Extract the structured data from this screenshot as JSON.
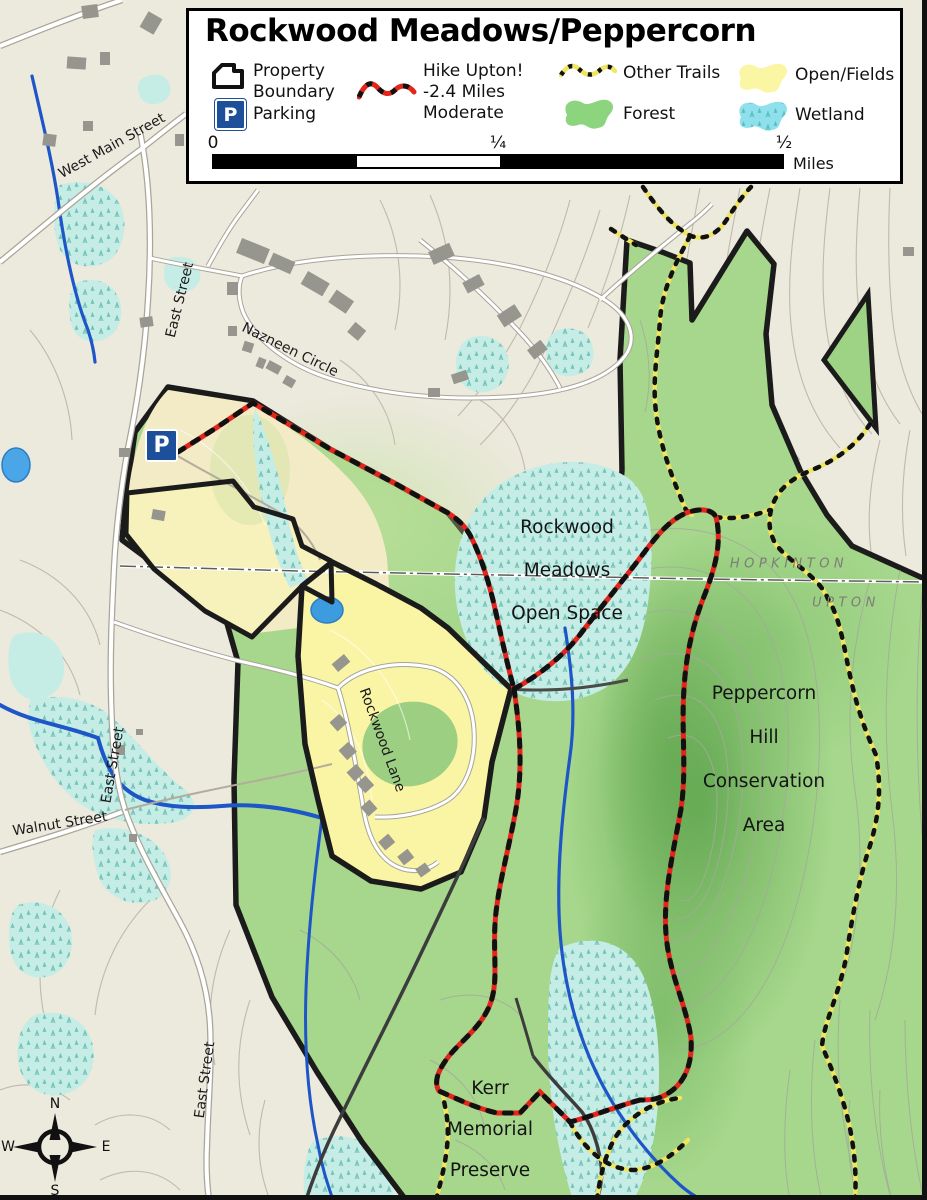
{
  "title": "Rockwood Meadows/Peppercorn",
  "legend": {
    "property_boundary": "Property\nBoundary",
    "parking": "Parking",
    "parking_symbol": "P",
    "hike": "Hike Upton!\n-2.4 Miles\nModerate",
    "other_trails": "Other Trails",
    "forest": "Forest",
    "open_fields": "Open/Fields",
    "wetland": "Wetland"
  },
  "scale_bar": {
    "tick0": "0",
    "tick1": "¼",
    "tick2": "½",
    "unit": "Miles"
  },
  "map_labels": {
    "rockwood": "Rockwood\nMeadows\nOpen Space",
    "peppercorn": "Peppercorn\nHill\nConservation\nArea",
    "kerr": "Kerr\nMemorial\nPreserve",
    "hopkinton": "HOPKINTON",
    "upton": "UPTON",
    "west_main": "West Main Street",
    "east_street": "East  Street",
    "walnut": "Walnut Street",
    "nazneen": "Nazneen Circle",
    "rockwood_lane": "Rockwood Lane",
    "parking_marker": "P"
  },
  "compass": {
    "n": "N",
    "e": "E",
    "s": "S",
    "w": "W"
  },
  "colors": {
    "forest_green": "#9AD283",
    "open_fields_yellow": "#FBF6A3",
    "wetland_cyan": "#8FE0ED",
    "water_blue": "#1E56C8",
    "hike_trail_red": "#E4251C",
    "other_trail_yellow": "#EFE55F",
    "parking_blue": "#1D4F9A",
    "boundary_black": "#1B1B1B"
  }
}
